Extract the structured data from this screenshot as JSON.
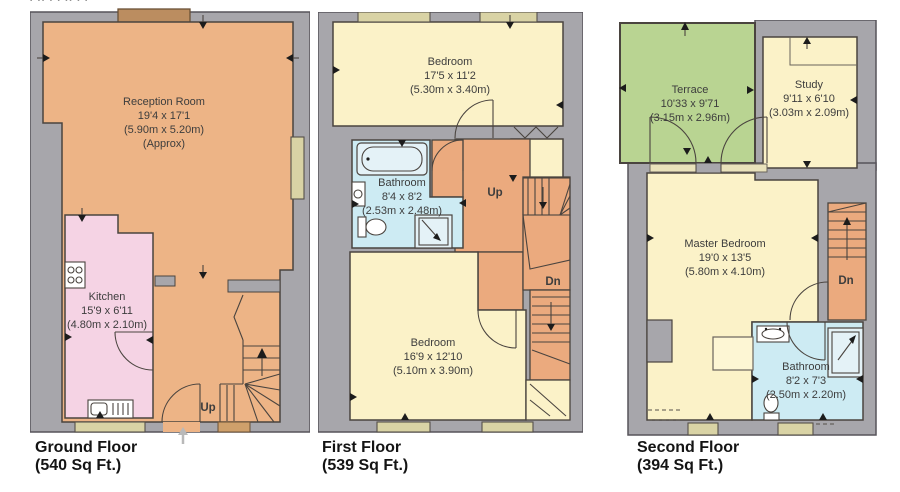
{
  "top_marks": "▪ ▪▪ ▪ ▪ ▪▪ ▪ ▪",
  "palette": {
    "wall": "#a7a6ab",
    "reception_orange": "#edb486",
    "kitchen_pink": "#f5d3e4",
    "bedroom_yellow": "#fbf2c8",
    "bathroom_blue": "#cdebf3",
    "terrace_green": "#b9d492",
    "hall_stairs_orange": "#ebaa7e",
    "window_slot": "#d9d3a5",
    "bay_brown": "#bb8d60"
  },
  "floors": [
    {
      "label": "Ground Floor",
      "area": "(540 Sq Ft.)",
      "rooms": {
        "reception": {
          "name": "Reception Room",
          "size_imperial": "19'4 x 17'1",
          "size_metric": "(5.90m x 5.20m)",
          "note": "(Approx)"
        },
        "kitchen": {
          "name": "Kitchen",
          "size_imperial": "15'9 x 6'11",
          "size_metric": "(4.80m x 2.10m)"
        }
      },
      "stairs": {
        "up": "Up"
      }
    },
    {
      "label": "First Floor",
      "area": "(539 Sq Ft.)",
      "rooms": {
        "bedroom_front": {
          "name": "Bedroom",
          "size_imperial": "17'5 x 11'2",
          "size_metric": "(5.30m x 3.40m)"
        },
        "bathroom": {
          "name": "Bathroom",
          "size_imperial": "8'4 x 8'2",
          "size_metric": "(2.53m x 2.48m)"
        },
        "bedroom_back": {
          "name": "Bedroom",
          "size_imperial": "16'9 x 12'10",
          "size_metric": "(5.10m x 3.90m)"
        }
      },
      "stairs": {
        "up": "Up",
        "down": "Dn"
      }
    },
    {
      "label": "Second Floor",
      "area": "(394 Sq Ft.)",
      "rooms": {
        "terrace": {
          "name": "Terrace",
          "size_imperial": "10'33 x 9'71",
          "size_metric": "(3.15m x 2.96m)"
        },
        "study": {
          "name": "Study",
          "size_imperial": "9'11 x 6'10",
          "size_metric": "(3.03m x 2.09m)"
        },
        "master": {
          "name": "Master Bedroom",
          "size_imperial": "19'0 x 13'5",
          "size_metric": "(5.80m x 4.10m)"
        },
        "bathroom": {
          "name": "Bathroom",
          "size_imperial": "8'2 x 7'3",
          "size_metric": "(2.50m x 2.20m)"
        }
      },
      "stairs": {
        "down": "Dn"
      }
    }
  ]
}
